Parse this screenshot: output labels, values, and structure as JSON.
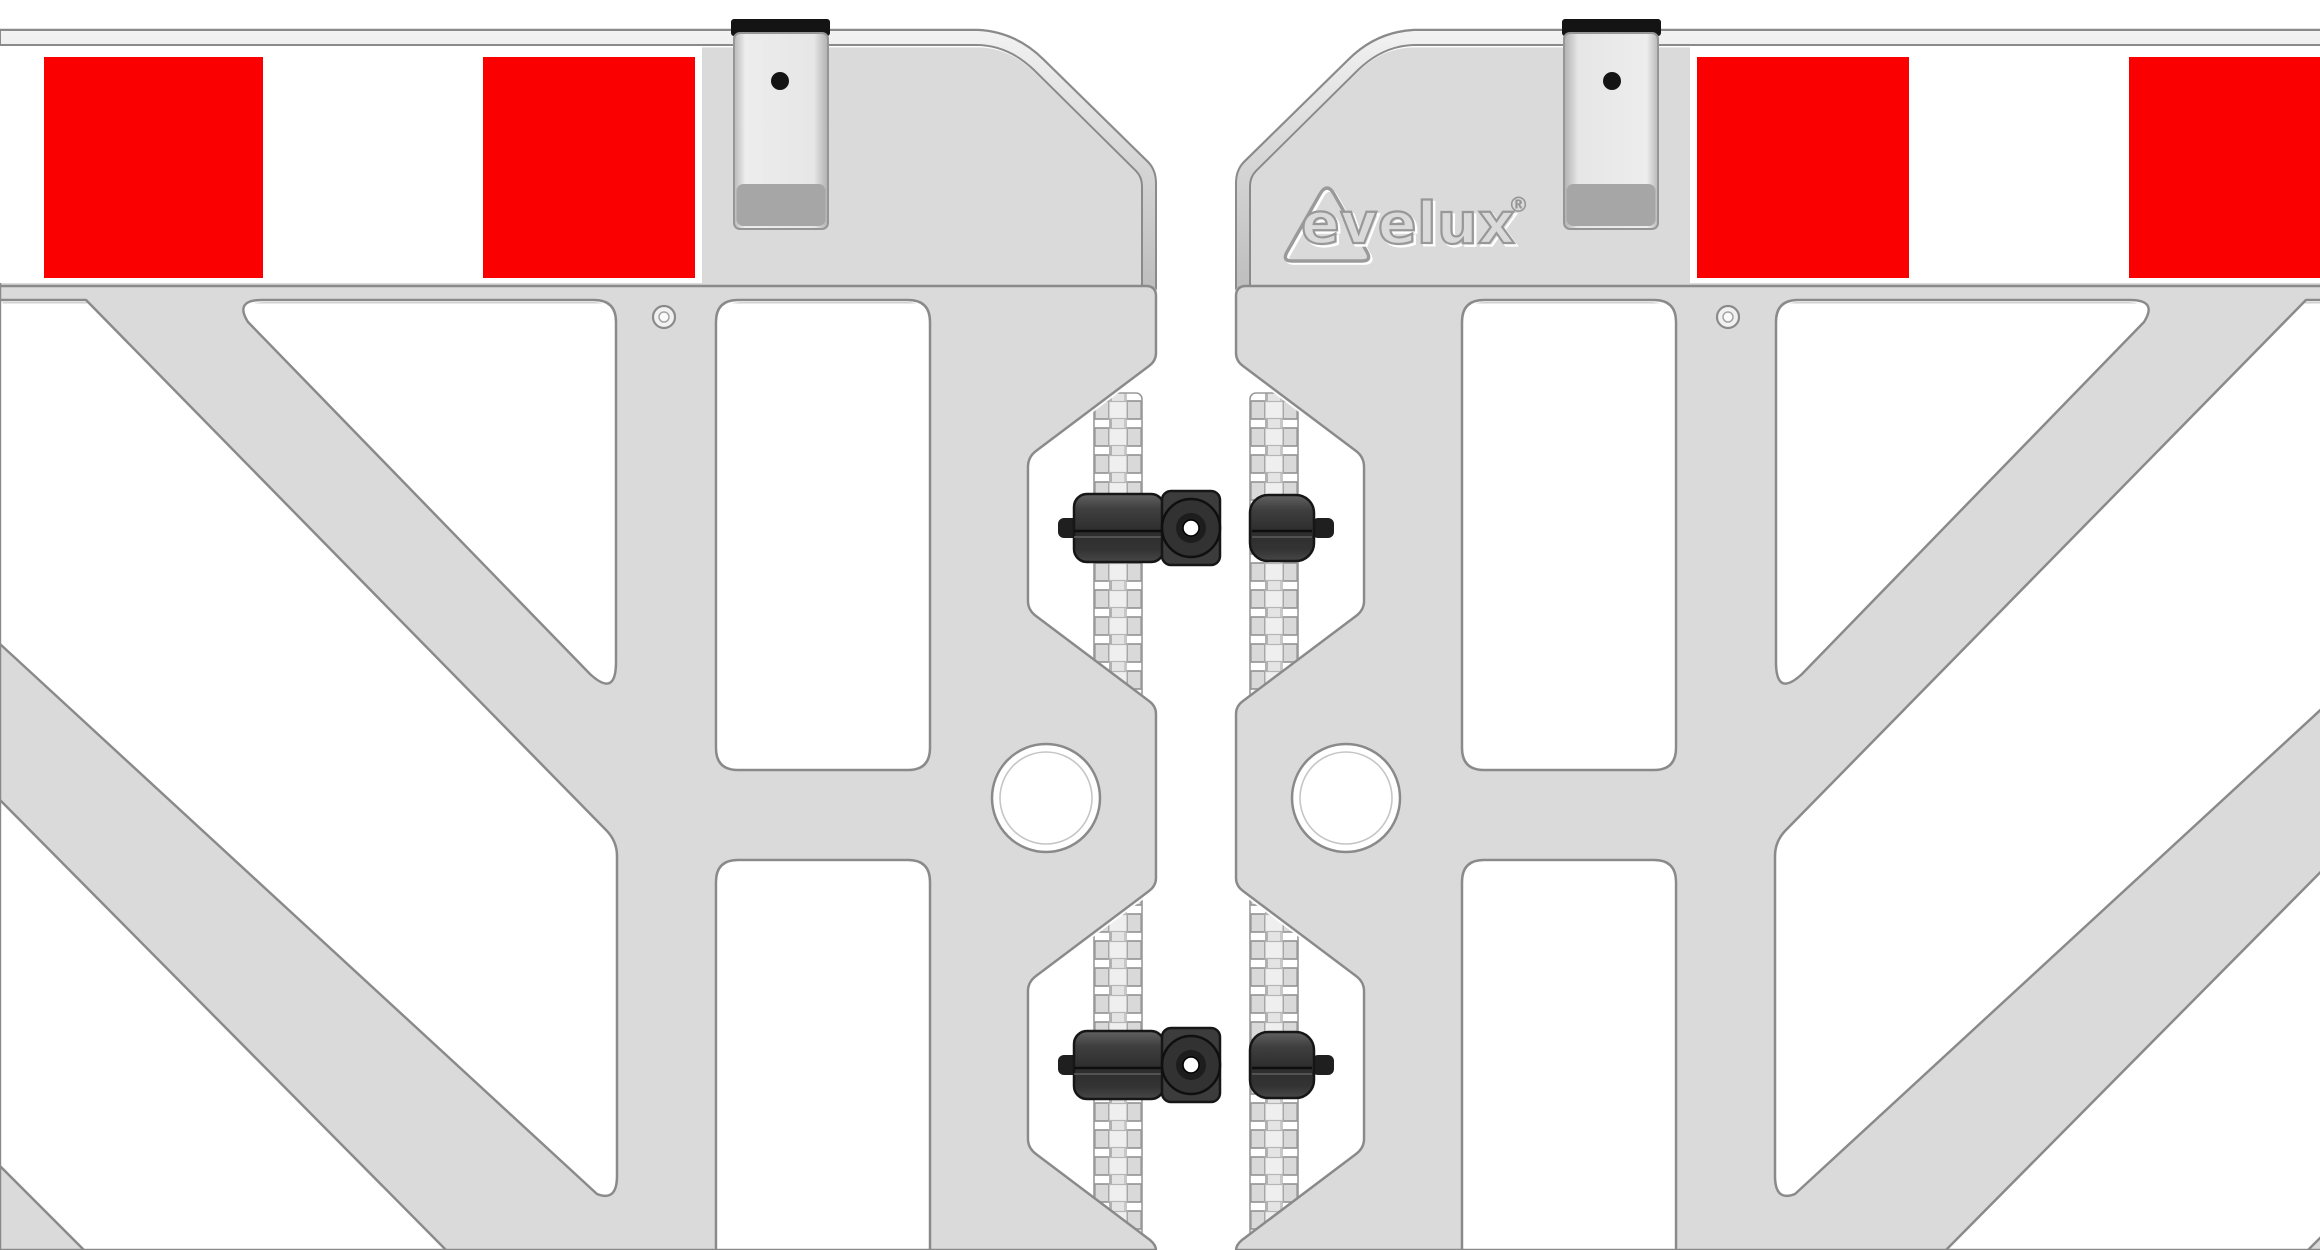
{
  "scene": {
    "type": "product-illustration",
    "subject": "Close-up of two interlocking plastic barrier fence panels joined by two clamp couplers on toothed hinge rails",
    "background_color": "#ffffff"
  },
  "logo": {
    "text": "evelux",
    "registered_mark": "®"
  },
  "panels": {
    "count": 2,
    "body_color": "#dadada",
    "emboss_line_color": "#8a8a8a",
    "reflective_band": {
      "red": "#fb0000",
      "white": "#ffffff",
      "red_squares_visible": 4
    }
  },
  "connectors": {
    "clamp_count": 2,
    "clamp_color": "#3a3a3a",
    "clamp_outline": "#161616",
    "bolt_hole_color": "#ffffff",
    "rail_color": "#e4e4e4"
  },
  "hangers": {
    "count": 2,
    "cap_color": "#141414",
    "body_color": "#ededed",
    "shade_color": "#a6a6a6",
    "pin_hole_color": "#141414"
  },
  "holes": {
    "round_hole_count": 2,
    "screw_mark_count": 2
  }
}
